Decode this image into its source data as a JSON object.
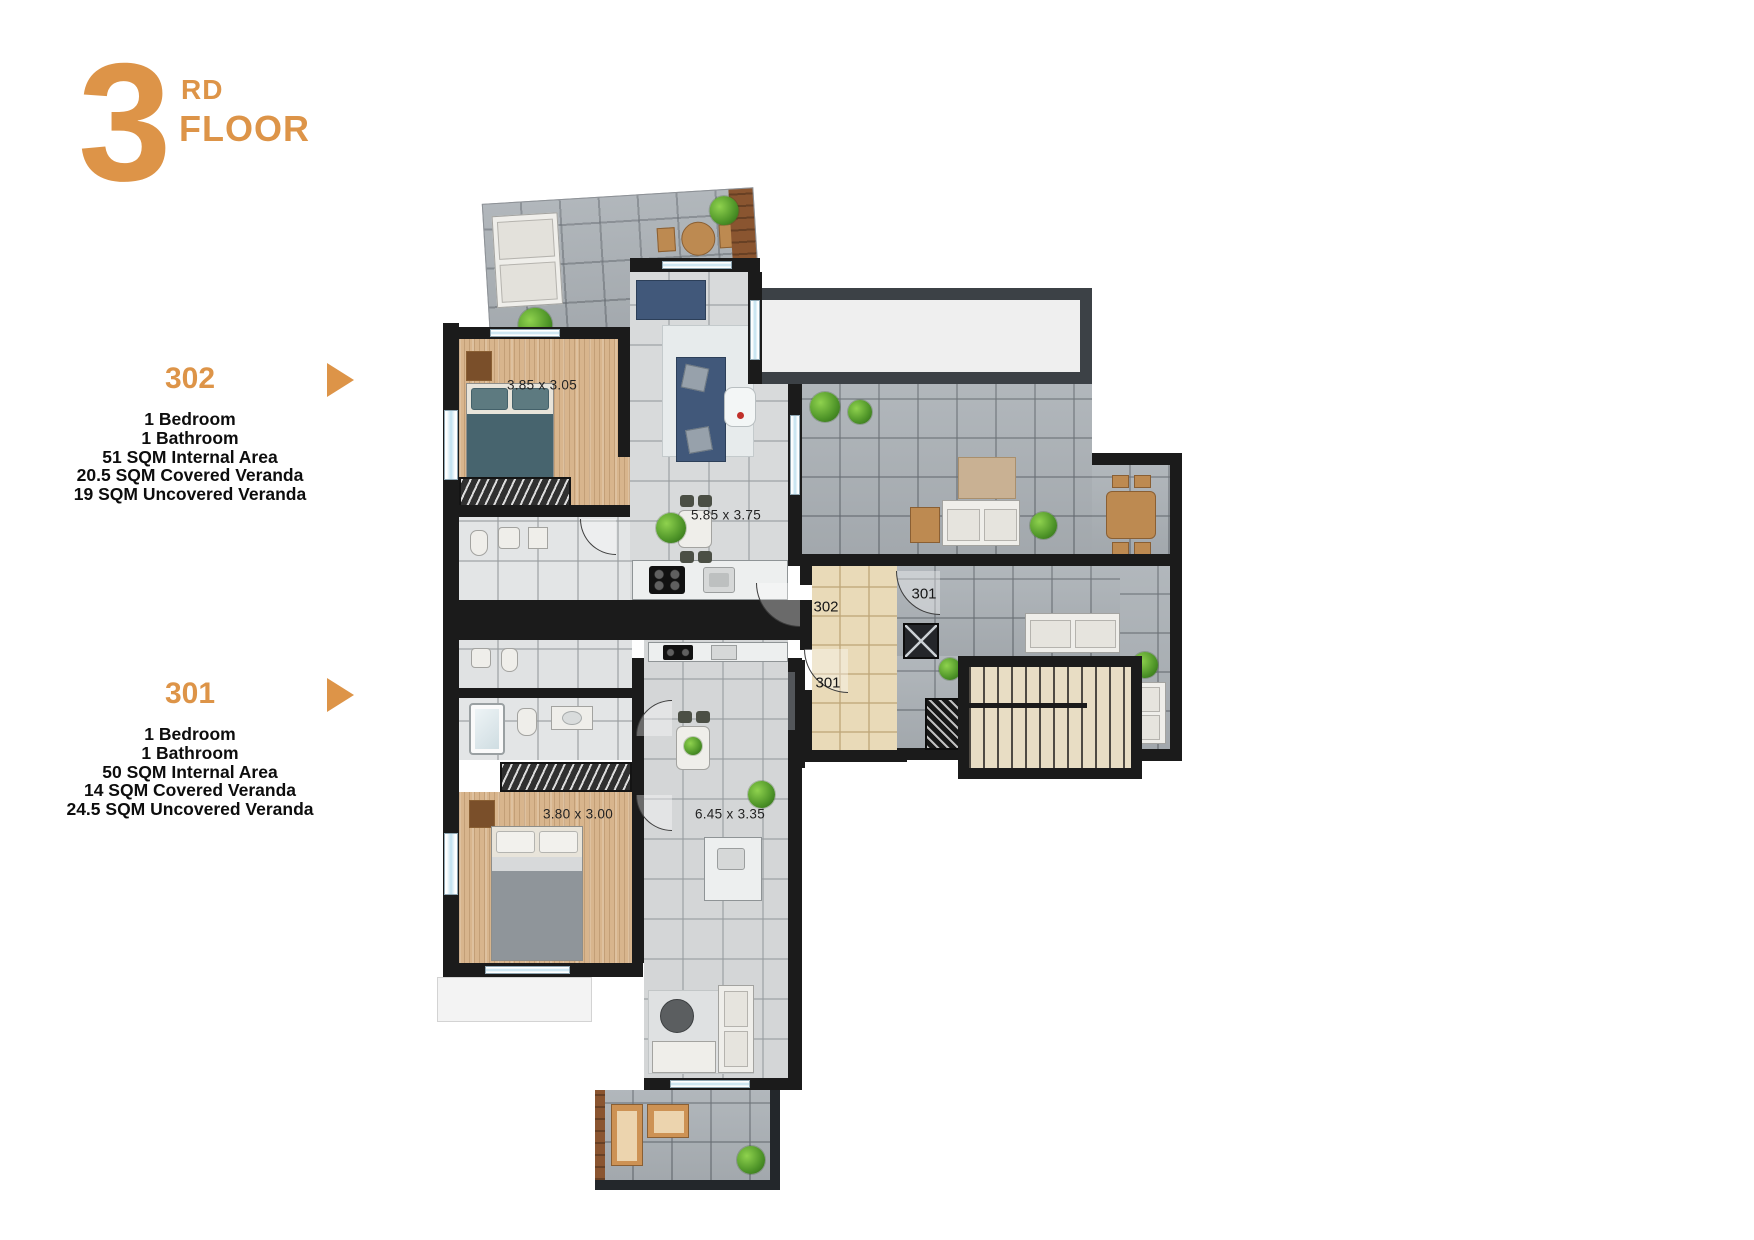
{
  "header": {
    "floor_number": "3",
    "floor_ordinal_suffix": "RD",
    "floor_label": "FLOOR"
  },
  "units": [
    {
      "id": "302",
      "details": [
        "1 Bedroom",
        "1 Bathroom",
        "51 SQM Internal Area",
        "20.5 SQM Covered Veranda",
        "19 SQM Uncovered Veranda"
      ]
    },
    {
      "id": "301",
      "details": [
        "1 Bedroom",
        "1 Bathroom",
        "50 SQM Internal Area",
        "14 SQM Covered Veranda",
        "24.5 SQM Uncovered Veranda"
      ]
    }
  ],
  "plan": {
    "dimensions": [
      {
        "room": "bedroom-302",
        "label": "3.85 x 3.05"
      },
      {
        "room": "living-kitchen-302",
        "label": "5.85 x 3.75"
      },
      {
        "room": "bedroom-301",
        "label": "3.80 x 3.00"
      },
      {
        "room": "living-kitchen-301",
        "label": "6.45 x 3.35"
      }
    ],
    "door_labels": [
      {
        "door": "entrance-302",
        "label": "302"
      },
      {
        "door": "veranda-door-301",
        "label": "301"
      },
      {
        "door": "entrance-301",
        "label": "301"
      }
    ]
  },
  "colors": {
    "accent": "#DD9448",
    "text": "#0d0d0d",
    "wall": "#1B1B1B"
  }
}
